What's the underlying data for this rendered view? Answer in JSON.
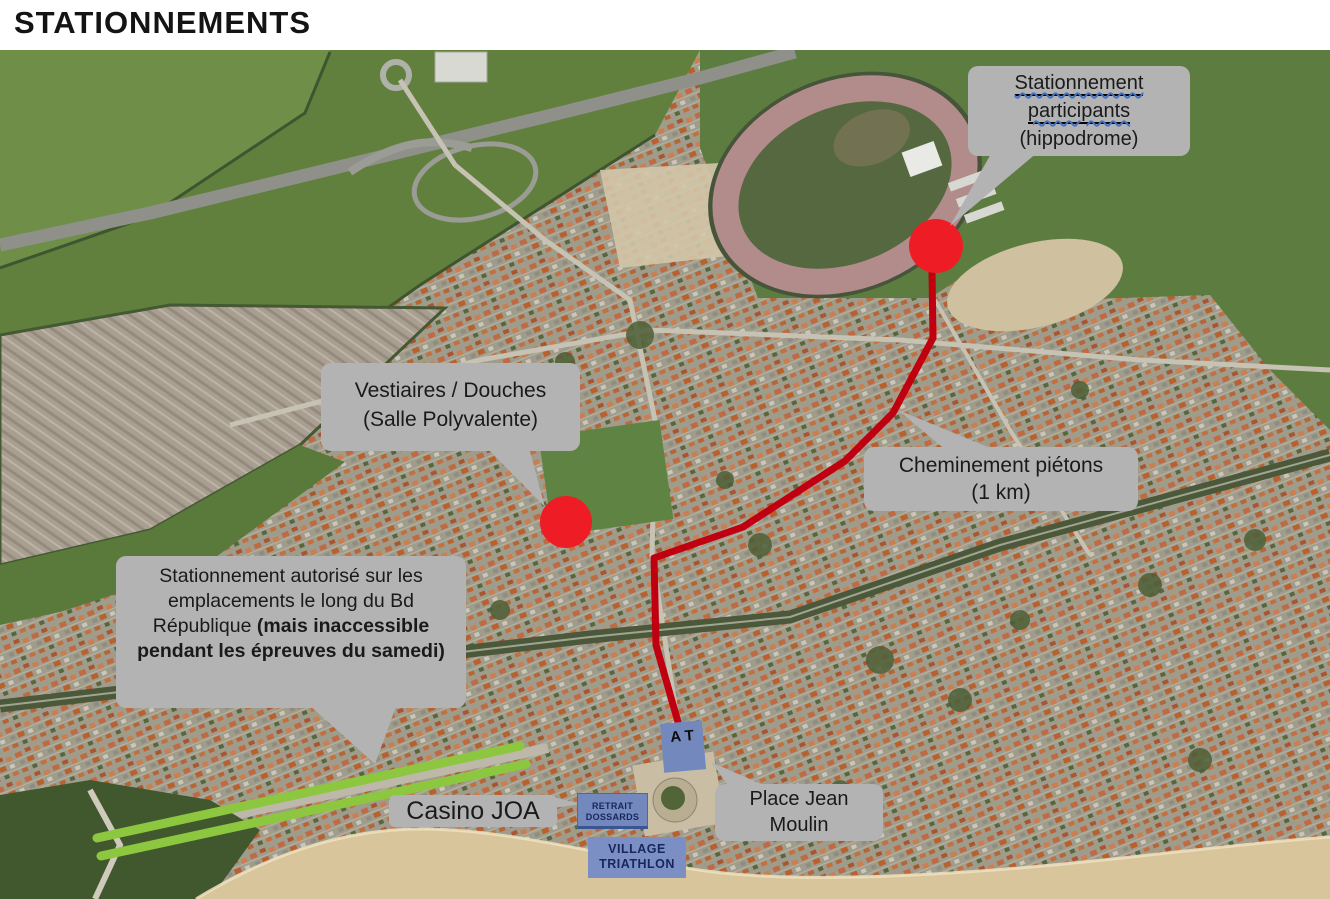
{
  "page": {
    "title": "STATIONNEMENTS"
  },
  "callouts": {
    "participants": {
      "line1": "Stationnement",
      "line2": "participants",
      "line3": "(hippodrome)"
    },
    "vestiaires": {
      "line1": "Vestiaires / Douches",
      "line2": "(Salle Polyvalente)"
    },
    "cheminement": {
      "line1": "Cheminement piétons",
      "line2": "(1 km)"
    },
    "bd_republique": {
      "normal": "Stationnement autorisé sur les emplacements le long du Bd République ",
      "bold": "(mais inaccessible pendant les épreuves du samedi)"
    },
    "casino": {
      "label": "Casino JOA"
    },
    "place_jean_moulin": {
      "line1": "Place Jean",
      "line2": "Moulin"
    }
  },
  "markers": {
    "retrait_dossards": {
      "line1": "RETRAIT",
      "line2": "DOSSARDS"
    },
    "village_triathlon": {
      "line1": "VILLAGE",
      "line2": "TRIATHLON"
    },
    "at_box": {
      "line1": "A",
      "line2": "T"
    }
  },
  "legend_colors": {
    "callout_gray": "#b3b3b3",
    "marker_red": "#ee1c25",
    "route_red": "#c00010",
    "parking_green": "#8dc63f",
    "info_blue": "#7388bd"
  }
}
